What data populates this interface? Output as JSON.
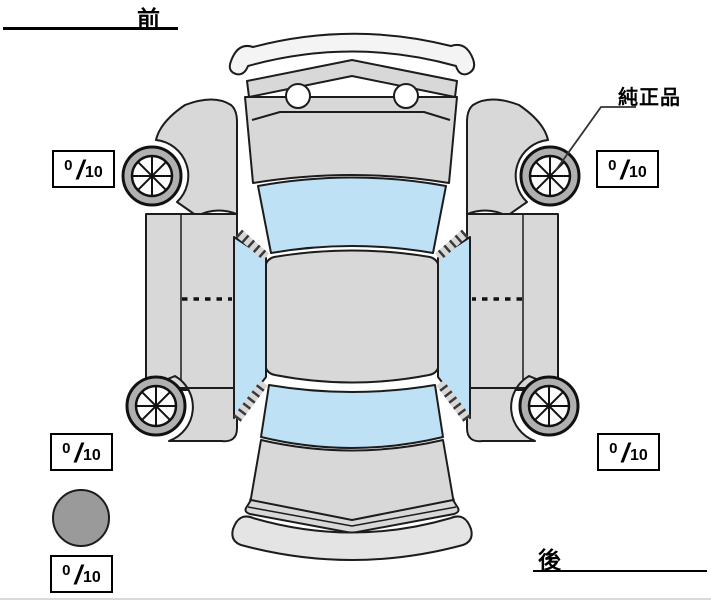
{
  "labels": {
    "front": "前",
    "rear": "後",
    "genuine_part": "純正品"
  },
  "separator": "/",
  "tread_depths": {
    "front_left": {
      "value": "0",
      "max": "10"
    },
    "front_right": {
      "value": "0",
      "max": "10"
    },
    "rear_left": {
      "value": "0",
      "max": "10"
    },
    "rear_right": {
      "value": "0",
      "max": "10"
    },
    "spare": {
      "value": "0",
      "max": "10"
    }
  },
  "icons": {
    "wheel": "spoked-wheel",
    "spare_tire": "filled-gray-circle",
    "car": "car-top-view-outline"
  },
  "colors": {
    "body": "#d8d8d8",
    "glass": "#bee1f6",
    "tire_ring": "#b0b0b0",
    "spare_fill": "#9a9a9a",
    "bumper_front": "#f4f4f4",
    "bumper_rear": "#e4e4e4",
    "outline": "#1c1c1c"
  }
}
